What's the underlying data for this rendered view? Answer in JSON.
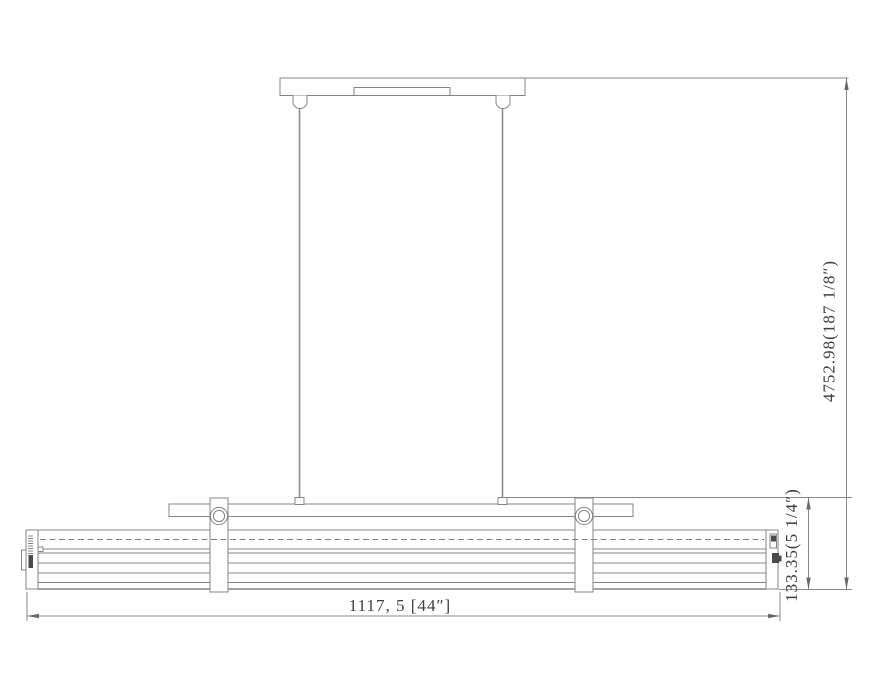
{
  "page": {
    "background": "#ffffff"
  },
  "drawing": {
    "description": "Linear pendant light fixture dimension drawing",
    "colors": {
      "line": "#848484",
      "dimension_line": "#8a8a8a",
      "text": "#3f3f3f",
      "detail_fill": "#4a4a4a"
    },
    "dimensions": {
      "overall_width": {
        "label": "1117, 5 [44″]"
      },
      "fixture_height": {
        "label": "133.35(5 1/4″)"
      },
      "overall_drop_height": {
        "label": "4752.98(187 1/8″)"
      }
    }
  }
}
